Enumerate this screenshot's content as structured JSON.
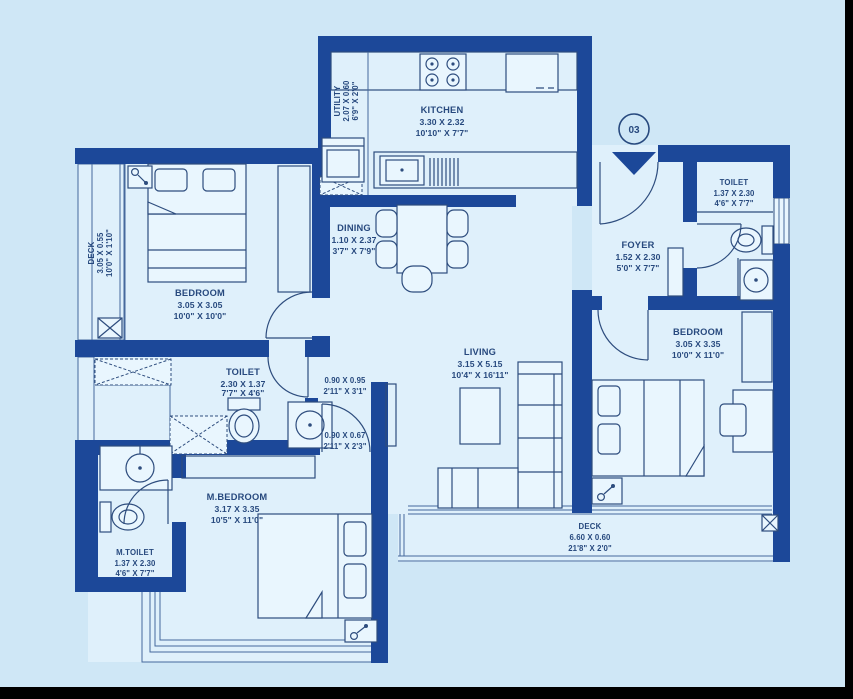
{
  "unit": {
    "number": "03"
  },
  "colors": {
    "background": "#cfe7f6",
    "floor": "#dff0fb",
    "wall": "#1c4899",
    "line": "#2e4d7e",
    "text": "#27497e"
  },
  "rooms": {
    "utility": {
      "name": "UTILITY",
      "m": "2.07 X 0.60",
      "ft": "6'9\" X 2'0\""
    },
    "kitchen": {
      "name": "KITCHEN",
      "m": "3.30 X 2.32",
      "ft": "10'10\" X 7'7\""
    },
    "dining": {
      "name": "DINING",
      "m": "1.10 X 2.37",
      "ft": "3'7\" X 7'9\""
    },
    "deck_left": {
      "name": "DECK",
      "m": "3.05 X 0.55",
      "ft": "10'0\" X 1'10\""
    },
    "bedroom_left": {
      "name": "BEDROOM",
      "m": "3.05 X 3.05",
      "ft": "10'0\" X 10'0\""
    },
    "toilet_mid": {
      "name": "TOILET",
      "m": "2.30 X 1.37",
      "ft": "7'7\" X 4'6\""
    },
    "passage_upper": {
      "m": "0.90 X 0.95",
      "ft": "2'11\" X 3'1\""
    },
    "passage_lower": {
      "m": "0.90 X 0.67",
      "ft": "2'11\" X 2'3\""
    },
    "living": {
      "name": "LIVING",
      "m": "3.15 X 5.15",
      "ft": "10'4\" X 16'11\""
    },
    "foyer": {
      "name": "FOYER",
      "m": "1.52 X 2.30",
      "ft": "5'0\" X 7'7\""
    },
    "toilet_right": {
      "name": "TOILET",
      "m": "1.37 X 2.30",
      "ft": "4'6\" X 7'7\""
    },
    "bedroom_right": {
      "name": "BEDROOM",
      "m": "3.05 X 3.35",
      "ft": "10'0\" X 11'0\""
    },
    "m_bedroom": {
      "name": "M.BEDROOM",
      "m": "3.17 X 3.35",
      "ft": "10'5\" X 11'0\""
    },
    "m_toilet": {
      "name": "M.TOILET",
      "m": "1.37 X 2.30",
      "ft": "4'6\" X 7'7\""
    },
    "deck_bottom": {
      "name": "DECK",
      "m": "6.60 X 0.60",
      "ft": "21'8\" X 2'0\""
    }
  }
}
